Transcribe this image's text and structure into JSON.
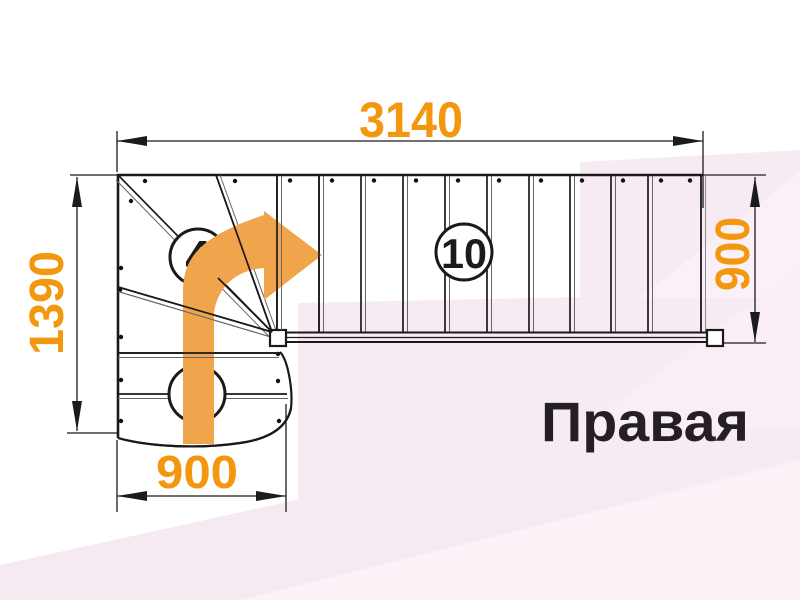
{
  "drawing": {
    "stair_type_label": "Правая",
    "dimensions": {
      "total_run": "3140",
      "total_depth": "1390",
      "upper_flight_width": "900",
      "lower_flight_width": "900"
    },
    "step_counts": {
      "upper_flight": "10",
      "winders": "4",
      "lower_flight": "2"
    },
    "colors": {
      "dimension_text_orange": "#F2970E",
      "direction_arrow_orange": "#F0A44C",
      "line_black": "#1A1A1A",
      "background_pink": "#F7EBF3",
      "background_pink_light": "#FBF2F8"
    }
  }
}
